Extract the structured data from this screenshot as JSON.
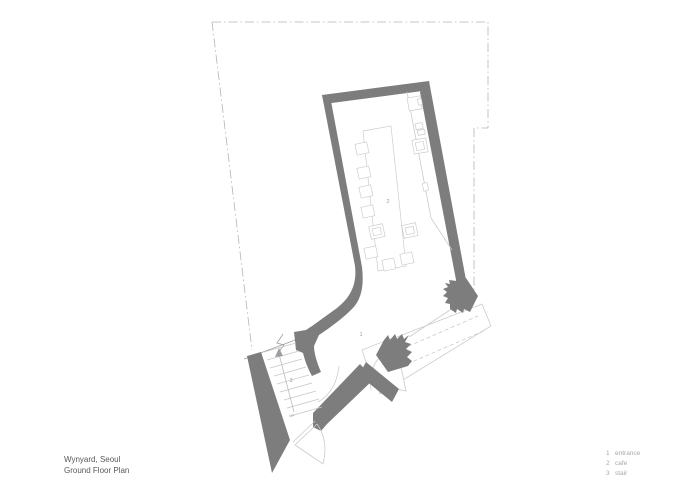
{
  "title_block": {
    "project": "Wynyard, Seoul",
    "drawing": "Ground Floor Plan"
  },
  "plan_labels": {
    "entrance_number": "1",
    "cafe_number": "2",
    "stair_number": "3",
    "up_text": "UP"
  },
  "legend": {
    "items": [
      {
        "number": "1",
        "label": "entrance"
      },
      {
        "number": "2",
        "label": "cafe"
      },
      {
        "number": "3",
        "label": "stair"
      }
    ]
  },
  "colors": {
    "background": "#ffffff",
    "wall_gray": "#7d7d7d",
    "light_line_gray": "#c9cbcc",
    "boundary_gray": "#b3b5b6",
    "label_gray": "#9aa0a3",
    "title_text_gray": "#58595b",
    "legend_text_gray": "#a6a8aa"
  }
}
